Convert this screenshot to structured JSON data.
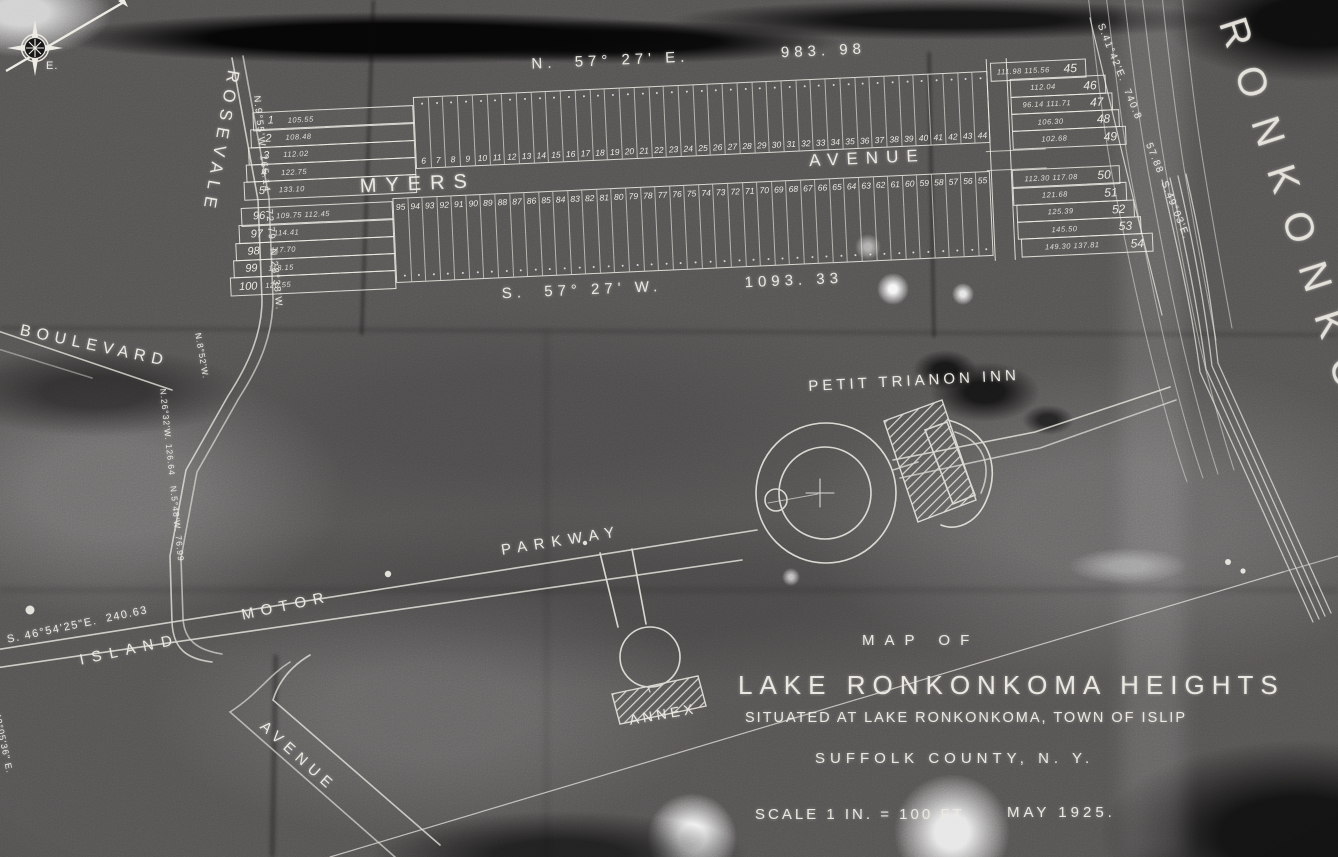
{
  "map": {
    "colors": {
      "paper": "#555352",
      "line": "#e9e7df",
      "shadow_black": "#060606"
    },
    "title_block": {
      "line1": "MAP OF",
      "line2": "LAKE RONKONKOMA HEIGHTS",
      "line3": "SITUATED AT LAKE RONKONKOMA, TOWN OF ISLIP",
      "line4": "SUFFOLK COUNTY, N. Y.",
      "scale": "SCALE 1 IN. = 100 FT.",
      "date": "MAY 1925."
    },
    "labels": {
      "lake_name": "RONKONKOMA",
      "inn": "PETIT TRIANON INN",
      "annex": "ANNEX",
      "myers": "MYERS",
      "avenue": "AVENUE",
      "rosevale": "ROSEVALE",
      "boulevard": "BOULEVARD",
      "island": "ISLAND",
      "motor": "MOTOR",
      "parkway": "PARKWAY",
      "avenue_sw": "AVENUE",
      "compass_east": "E."
    },
    "bearings": {
      "top": "N.  57° 27' E.          983. 98",
      "bottom": "S.  57° 27' W.         1093. 33",
      "left_edge": "N.9°55'W. 165.14    72.79  N.28°38'W.",
      "right_edge": "S.41°42'E.  740.8      57.88  S.49°03'E.",
      "parkway": "S. 46°54'25\"E.  240.63",
      "west_road": "N.26°32'W. 126.64   N.5°48'W. 76.99",
      "west_road_upper": "N.8°52'W.",
      "southwest": "43°05'36\" E."
    },
    "plat": {
      "left_top": [
        {
          "num": "1",
          "dim": "105.55"
        },
        {
          "num": "2",
          "dim": "108.48"
        },
        {
          "num": "3",
          "dim": "112.02"
        },
        {
          "num": "4",
          "dim": "122.75"
        },
        {
          "num": "5",
          "dim": "133.10"
        }
      ],
      "left_bottom": [
        {
          "num": "96",
          "dim": "109.75  112.45"
        },
        {
          "num": "97",
          "dim": "114.41"
        },
        {
          "num": "98",
          "dim": "117.70"
        },
        {
          "num": "99",
          "dim": "118.15"
        },
        {
          "num": "100",
          "dim": "120.55"
        }
      ],
      "right_top": [
        {
          "num": "45",
          "dim": "111.98  115.56"
        },
        {
          "num": "46",
          "dim": "112.04"
        },
        {
          "num": "47",
          "dim": "96.14  111.71"
        },
        {
          "num": "48",
          "dim": "106.30"
        },
        {
          "num": "49",
          "dim": "102.68"
        }
      ],
      "right_bottom": [
        {
          "num": "50",
          "dim": "112.30  117.08"
        },
        {
          "num": "51",
          "dim": "121.68"
        },
        {
          "num": "52",
          "dim": "125.39"
        },
        {
          "num": "53",
          "dim": "145.50"
        },
        {
          "num": "54",
          "dim": "149.30  137.81"
        }
      ],
      "top_row": [
        "6",
        "7",
        "8",
        "9",
        "10",
        "11",
        "12",
        "13",
        "14",
        "15",
        "16",
        "17",
        "18",
        "19",
        "20",
        "21",
        "22",
        "23",
        "24",
        "25",
        "26",
        "27",
        "28",
        "29",
        "30",
        "31",
        "32",
        "33",
        "34",
        "35",
        "36",
        "37",
        "38",
        "39",
        "40",
        "41",
        "42",
        "43",
        "44"
      ],
      "bottom_row": [
        "95",
        "94",
        "93",
        "92",
        "91",
        "90",
        "89",
        "88",
        "87",
        "86",
        "85",
        "84",
        "83",
        "82",
        "81",
        "80",
        "79",
        "78",
        "77",
        "76",
        "75",
        "74",
        "73",
        "72",
        "71",
        "70",
        "69",
        "68",
        "67",
        "66",
        "65",
        "64",
        "63",
        "62",
        "61",
        "60",
        "59",
        "58",
        "57",
        "56",
        "55"
      ]
    }
  }
}
